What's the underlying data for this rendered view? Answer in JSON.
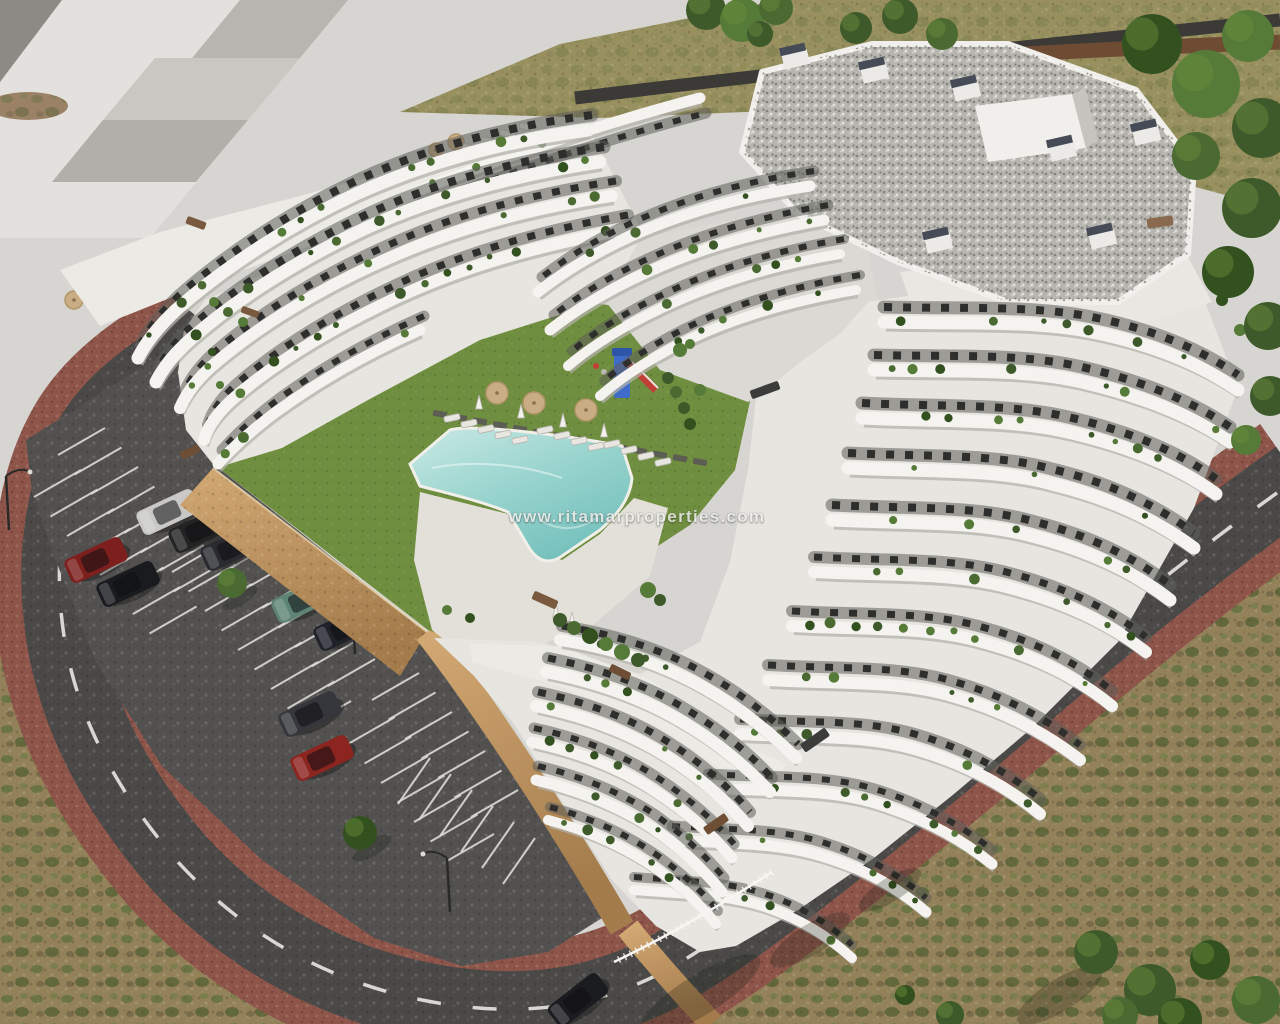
{
  "watermark": {
    "text": "www.ritamarproperties.com"
  },
  "scene": {
    "type": "aerial-architectural-render",
    "subject": "New-build terraced apartment complex with curved white balcony bands, communal lawn courtyard, free-form swimming pool and open-air parking",
    "setting": [
      "neighbouring pale stepped building",
      "perimeter streets with dashed centre lines",
      "red paver sidewalks",
      "dry scrubland verges",
      "green trees"
    ]
  },
  "palette": {
    "pavement": "#d6d5d1",
    "building_white": "#f4f3ef",
    "building_floor": "#e7e5e0",
    "facade_dark": "#4e4d49",
    "window_dark": "#2e2e2c",
    "roof_gravel": "#b7b5af",
    "lawn": "#6f8e3f",
    "pool_water": "#a7d8d2",
    "deck": "#e2e0d9",
    "asphalt_road": "#4a4947",
    "asphalt_parking": "#525150",
    "sidewalk_paver": "#8e564b",
    "retaining_wall": "#c29a66",
    "scrub": "#938159",
    "dry_grass": "#99905f",
    "tree_green": "#46622e",
    "playground_blue": "#3f6bca",
    "playground_red": "#c23f38",
    "parasol_tan": "#c9ae85",
    "road_marking": "#e8e7e2",
    "watermark_text": "#ededeb"
  },
  "courtyard": {
    "parasols": 3,
    "sun_loungers": 13,
    "playgrounds": 1,
    "pools": 1
  },
  "parking": {
    "bay_rows": 7,
    "streetlights": 3
  },
  "cars": {
    "count": 10,
    "colors": [
      "#c9c8c6",
      "#232323",
      "#2a2b30",
      "#7c1f1d",
      "#191b1f",
      "#5e8476",
      "#20222a",
      "#35373c",
      "#8c2420",
      "#1b1c20"
    ]
  }
}
